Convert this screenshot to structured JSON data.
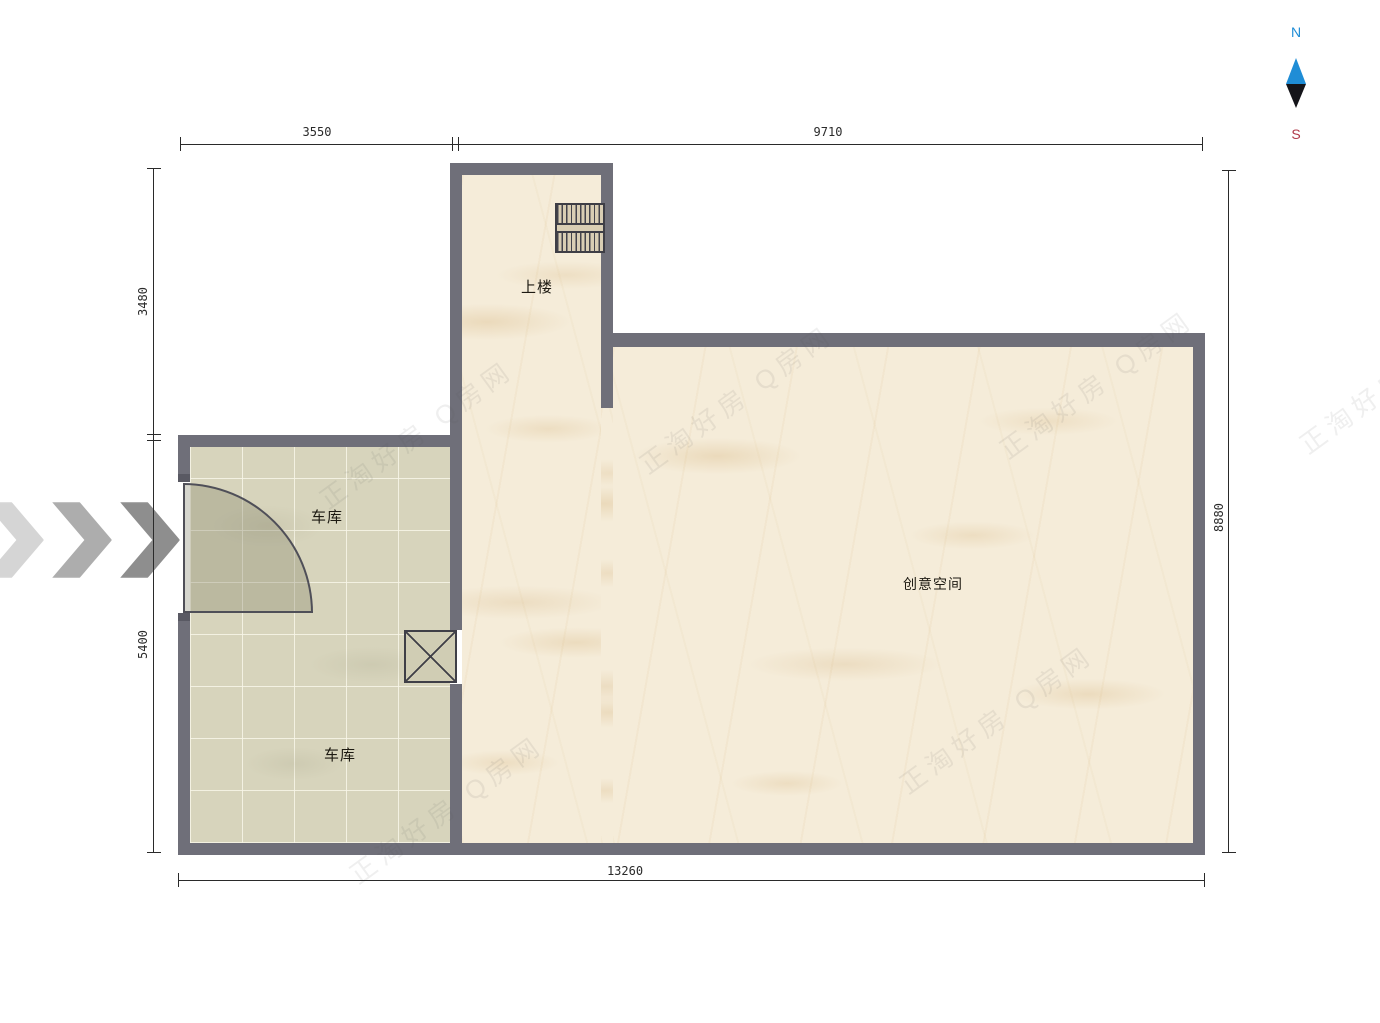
{
  "colors": {
    "wall": "#6f6f79",
    "floor_main": "#f5ecd9",
    "floor_garage": "#d7d4bc",
    "dim": "#2a2a2a",
    "north": "#1f8dd6",
    "south": "#b03a4a",
    "label": "#1d1a12"
  },
  "compass": {
    "north": "N",
    "south": "S"
  },
  "dimensions": {
    "top_left": "3550",
    "top_right": "9710",
    "left_upper": "3480",
    "left_lower": "5400",
    "right_side": "8880",
    "bottom": "13260"
  },
  "rooms": {
    "upstairs": "上楼",
    "garage_upper": "车库",
    "garage_lower": "车库",
    "creative_space": "创意空间"
  },
  "watermark": {
    "text": "正淘好房 Q房网"
  }
}
